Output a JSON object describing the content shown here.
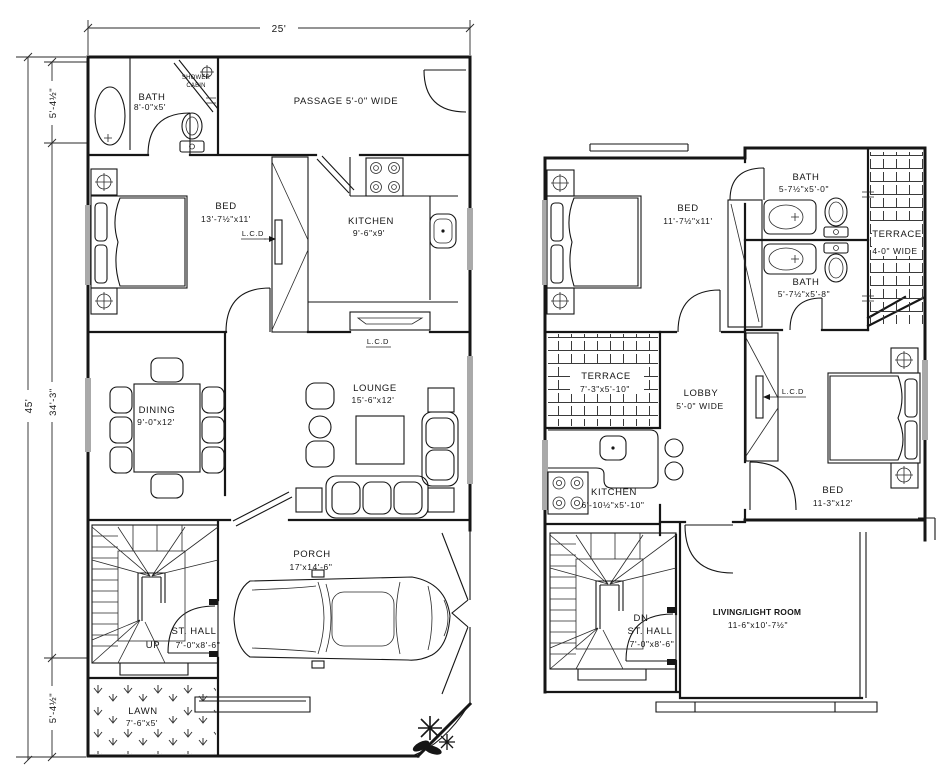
{
  "page": {
    "background": "#ffffff",
    "line_color": "#161616"
  },
  "dimensions": {
    "top_width": "25'",
    "left_total": "45'",
    "left_top": "5'-4½\"",
    "left_middle": "34'-3\"",
    "left_bottom": "5'-4½\""
  },
  "ground_floor": {
    "bath": {
      "name": "BATH",
      "size": "8'-0\"x5'"
    },
    "shower_cabin": {
      "line1": "SHOWER",
      "line2": "CABIN"
    },
    "passage": {
      "name": "PASSAGE 5'-0\" WIDE"
    },
    "bed": {
      "name": "BED",
      "size": "13'-7½\"x11'"
    },
    "lcd_bed": "L.C.D",
    "kitchen": {
      "name": "KITCHEN",
      "size": "9'-6\"x9'"
    },
    "dining": {
      "name": "DINING",
      "size": "9'-0\"x12'"
    },
    "lounge": {
      "name": "LOUNGE",
      "size": "15'-6\"x12'"
    },
    "lcd_lounge": "L.C.D",
    "stair_hall": {
      "name": "ST. HALL",
      "direction": "UP",
      "size": "7'-0\"x8'-6\""
    },
    "porch": {
      "name": "PORCH",
      "size": "17'x14'-6\""
    },
    "lawn": {
      "name": "LAWN",
      "size": "7'-6\"x5'"
    }
  },
  "first_floor": {
    "bed_front": {
      "name": "BED",
      "size": "11'-7½\"x11'"
    },
    "bath_top": {
      "name": "BATH",
      "size": "5-7½\"x5'-0\""
    },
    "bath_bottom": {
      "name": "BATH",
      "size": "5'-7½\"x5'-8\""
    },
    "terrace_side": {
      "name": "TERRACE",
      "size": "4-0\" WIDE"
    },
    "terrace_rear": {
      "name": "TERRACE",
      "size": "7'-3\"x5'-10\""
    },
    "lobby": {
      "name": "LOBBY",
      "size": "5'-0\" WIDE"
    },
    "lcd_lobby": "L.C.D",
    "kitchen": {
      "name": "KITCHEN",
      "size": "6'-10½\"x5'-10\""
    },
    "bed_rear": {
      "name": "BED",
      "size": "11-3\"x12'"
    },
    "stair_hall": {
      "direction": "DN",
      "name": "ST. HALL",
      "size": "7'-0\"x8'-6\""
    },
    "living": {
      "name": "LIVING/LIGHT ROOM",
      "size": "11-6\"x10'-7½\""
    }
  }
}
